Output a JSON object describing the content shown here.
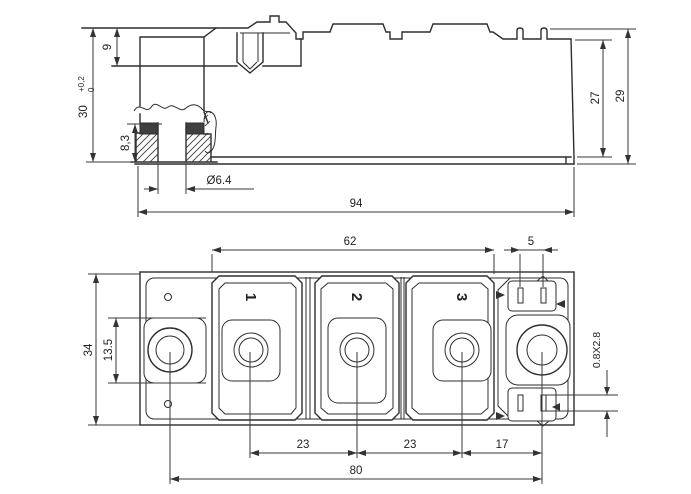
{
  "drawing": {
    "type": "technical dimensional drawing - power semiconductor module",
    "side_view": {
      "dims": {
        "terminal_height": "9",
        "overall_height": "30",
        "tol_plus": "+0,2",
        "tol_zero": "0",
        "bushing_height": "8,3",
        "hole_diameter": "Ø6.4",
        "length": "94",
        "body_height": "27",
        "total_height": "29"
      }
    },
    "plan_view": {
      "dims": {
        "terminal_span": "62",
        "tab_pitch": "5",
        "width": "34",
        "pad_size": "13.5",
        "pitch_a": "23",
        "pitch_b": "23",
        "pitch_c": "17",
        "mount_hole_pitch": "80",
        "tab_cross_section": "0.8X2.8"
      },
      "terminal_labels": [
        "1",
        "2",
        "3"
      ]
    }
  }
}
